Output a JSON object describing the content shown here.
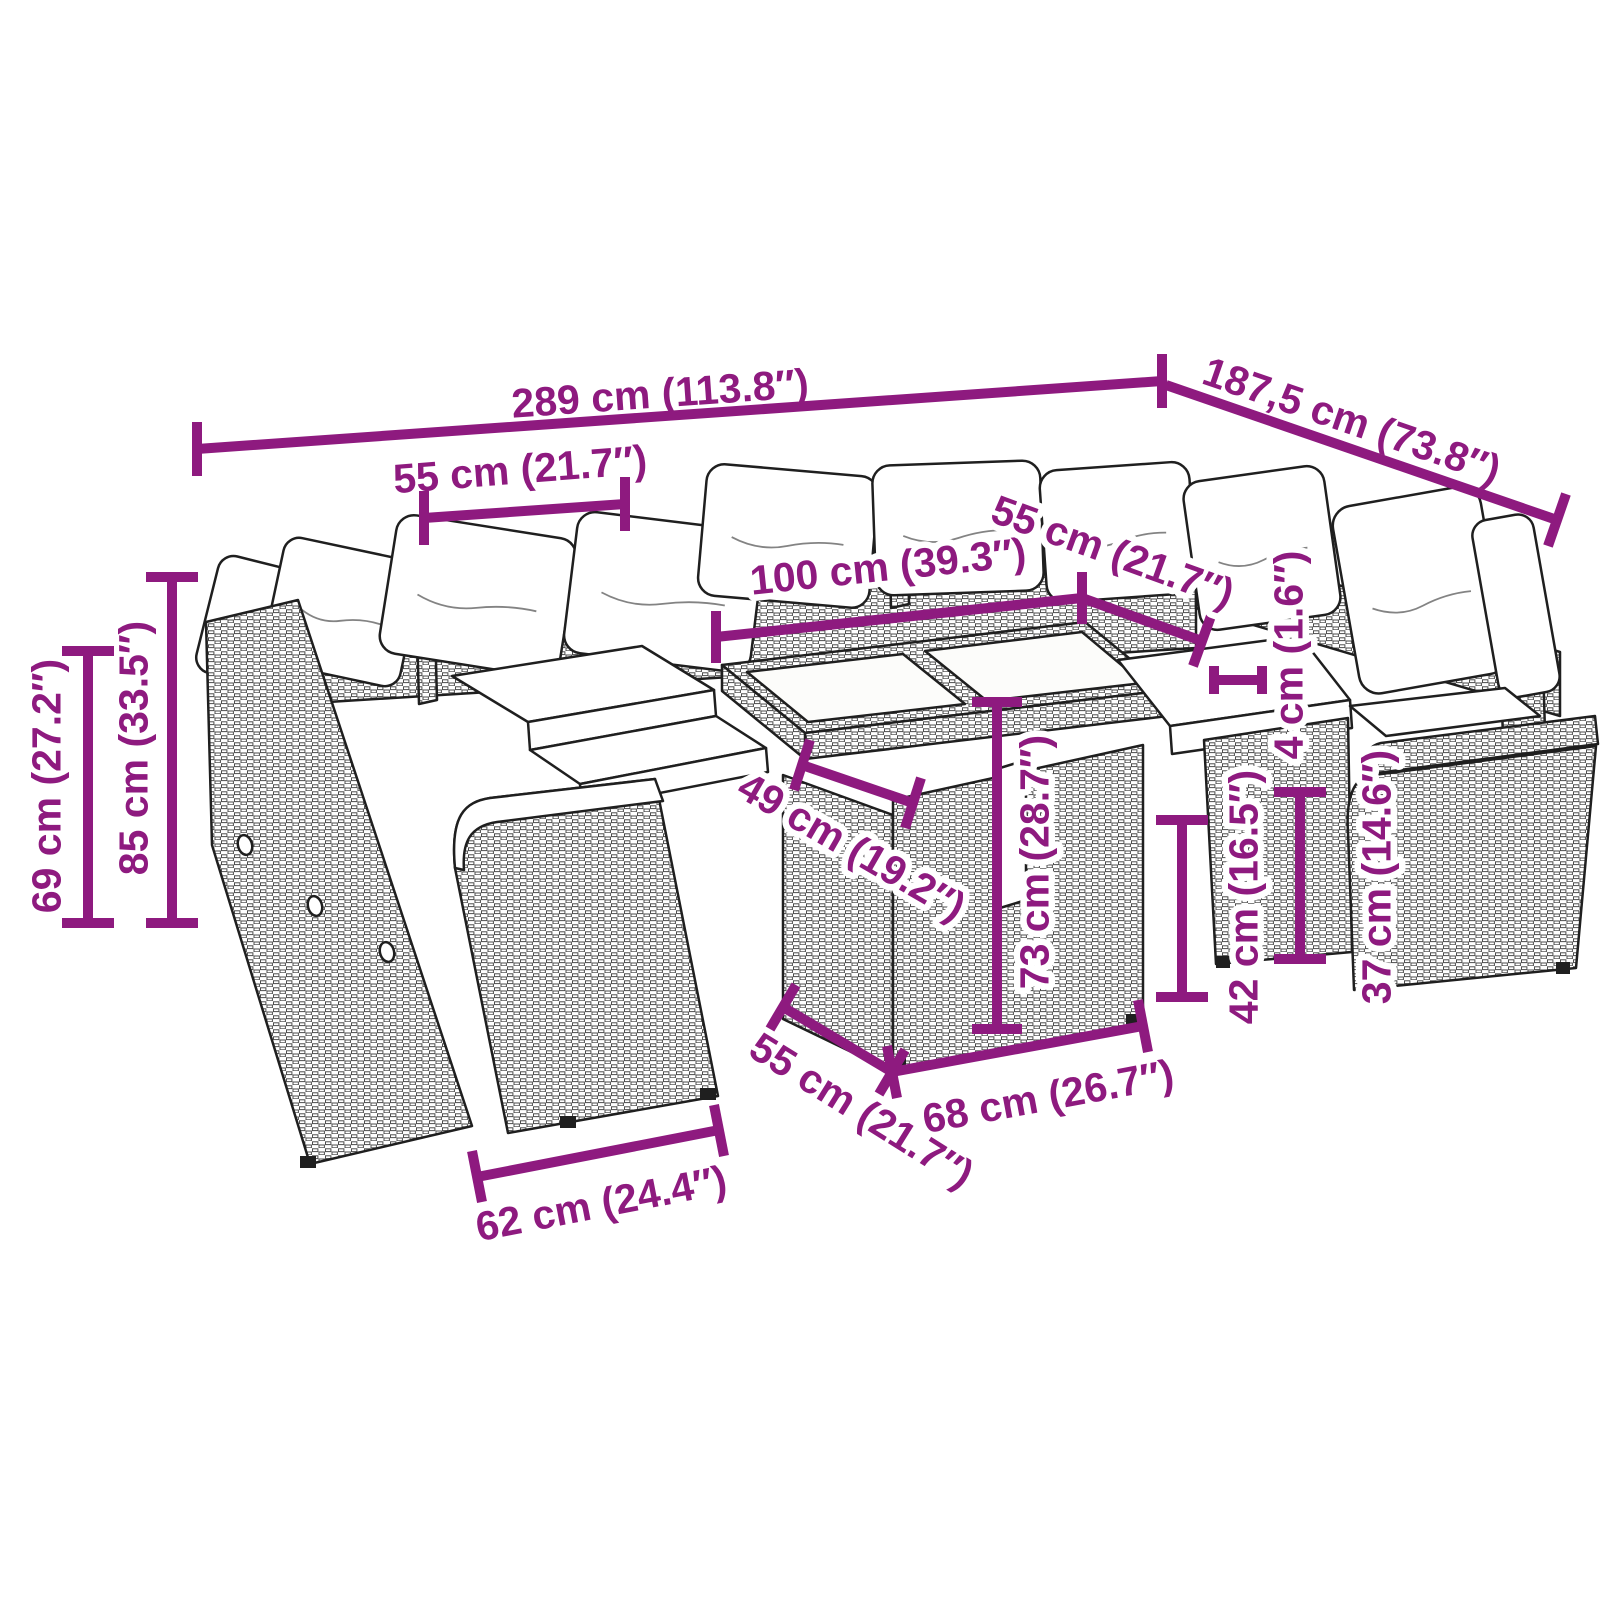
{
  "accent_color": "#8E1A7F",
  "dims": {
    "overall_width": "289 cm (113.8″)",
    "overall_depth": "187,5 cm (73.8″)",
    "back_seat_width_left": "55 cm (21.7″)",
    "table_length": "100 cm (39.3″)",
    "back_seat_width_right": "55 cm (21.7″)",
    "tabletop_thickness": "4 cm (1.6″)",
    "armrest_height": "69 cm (27.2″)",
    "total_height": "85 cm (33.5″)",
    "table_leg_span": "49 cm (19.2″)",
    "table_height": "73 cm (28.7″)",
    "seat_frame_height": "42 cm (16.5″)",
    "seat_height": "37 cm (14.6″)",
    "seat_depth": "55 cm (21.7″)",
    "table_base_width": "68 cm (26.7″)",
    "seat_outer_width": "62 cm (24.4″)"
  }
}
